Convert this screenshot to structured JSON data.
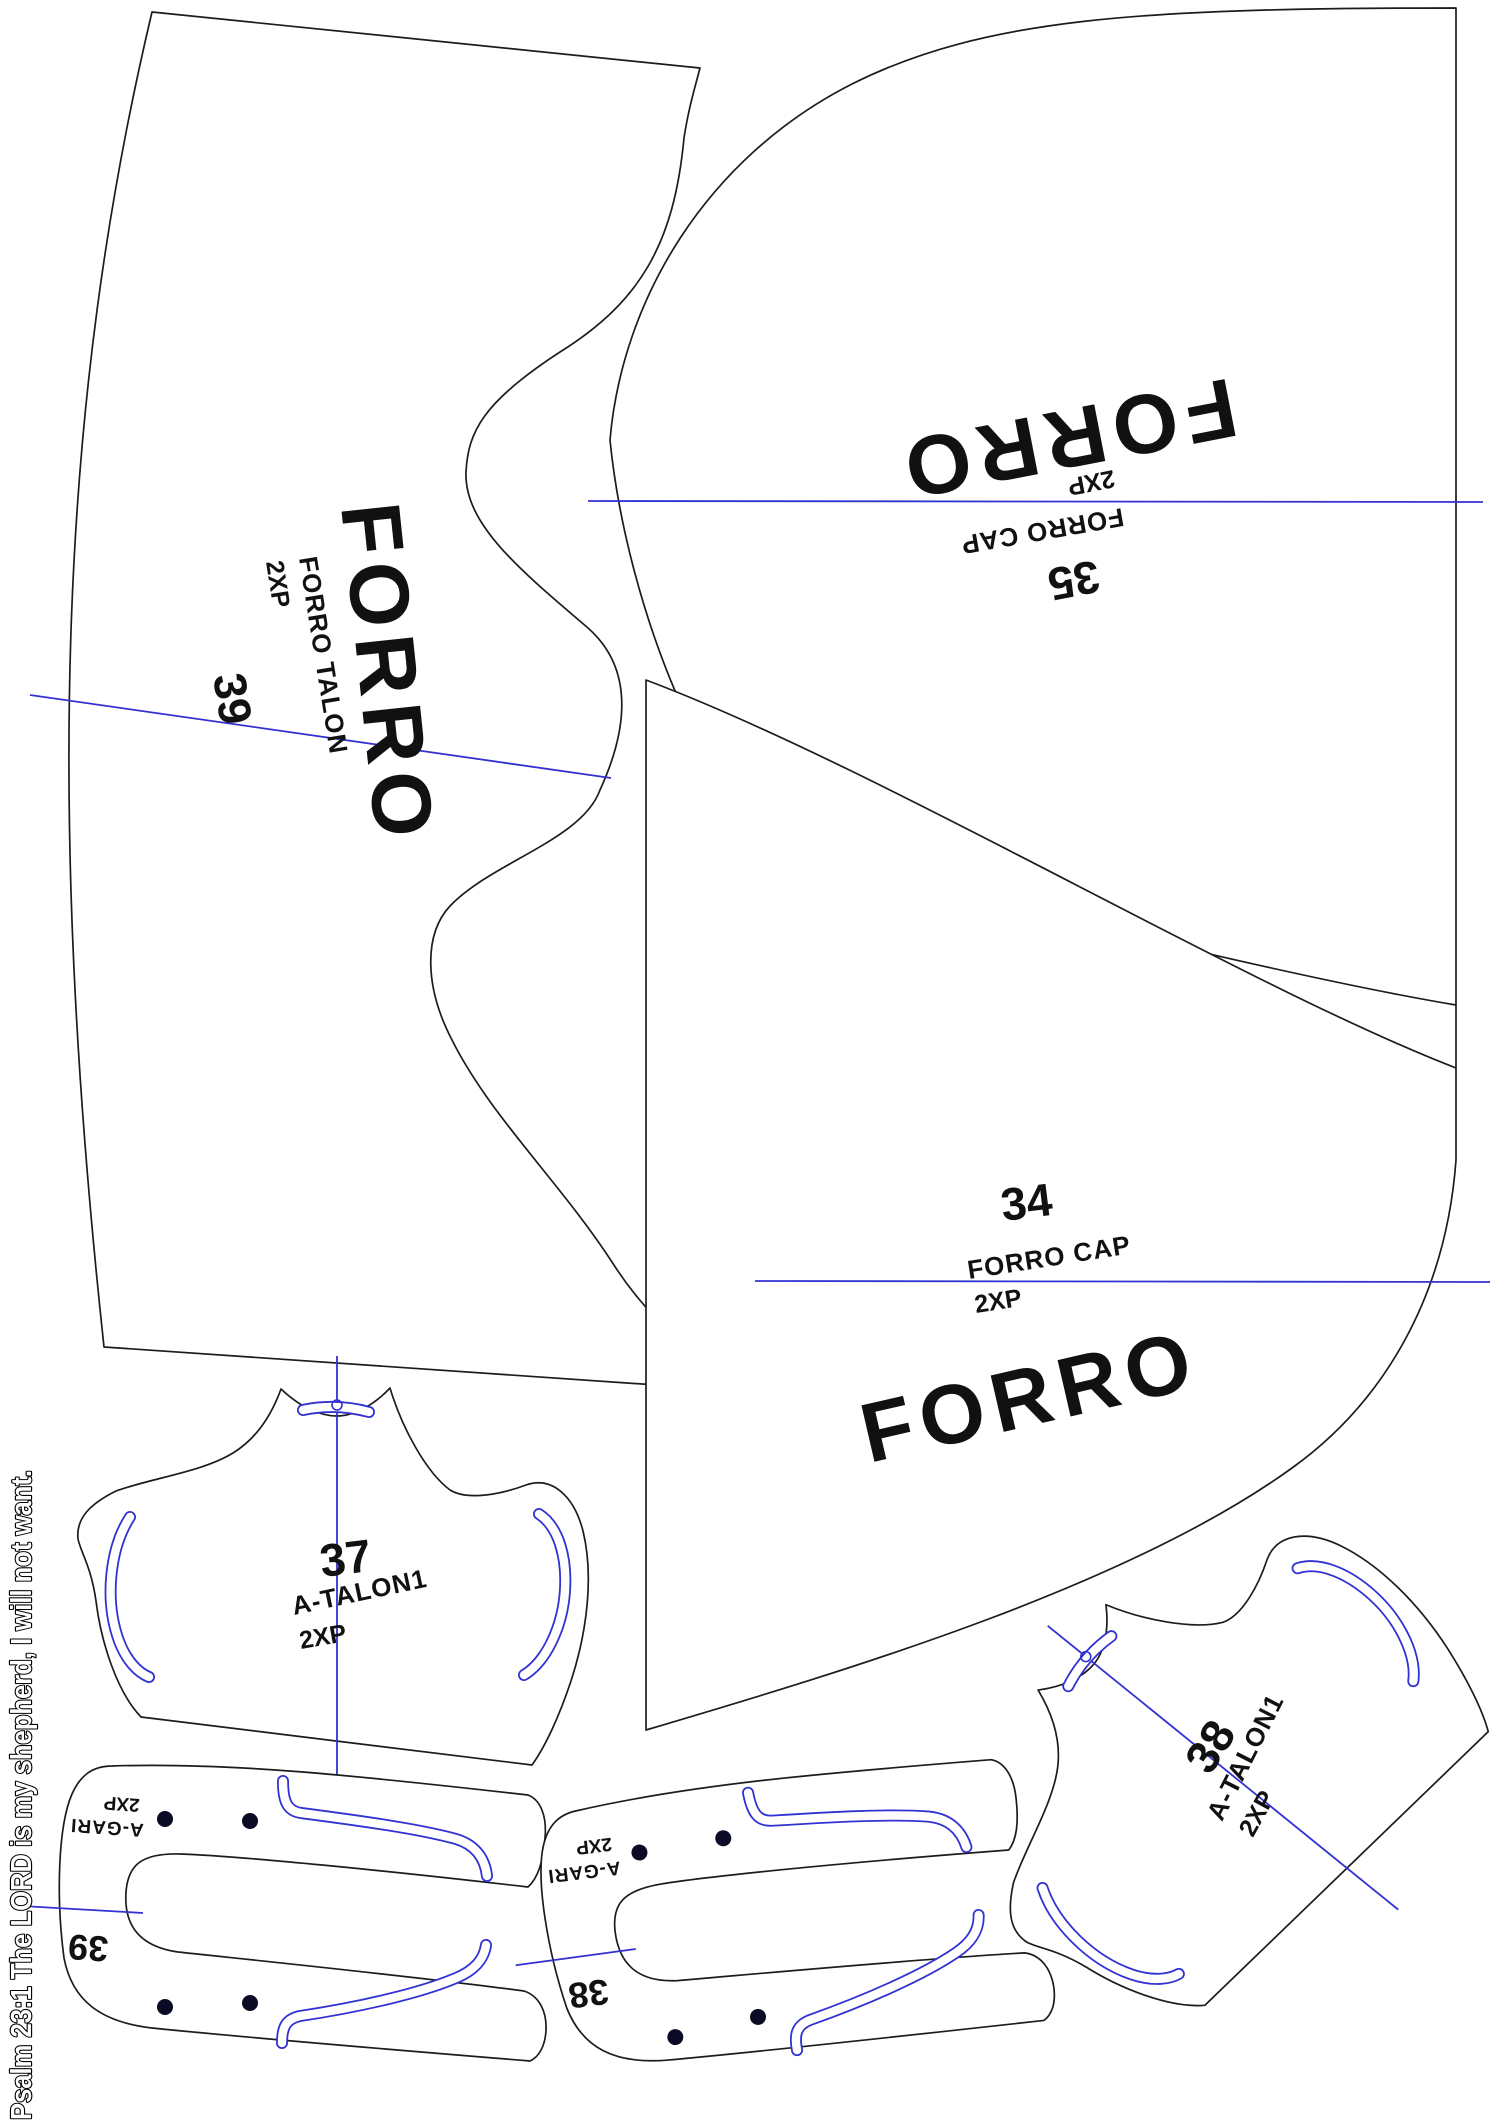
{
  "theme": {
    "paper": "#ffffff",
    "outline": "#1c1c1c",
    "guide": "#3232d2",
    "hole": "#0b0b26",
    "text": "#111111"
  },
  "side_note": {
    "text": "Psalm 23:1 The LORD is my shepherd, I will not want."
  },
  "pieces": {
    "forro_talon_39": {
      "big": "FORRO",
      "name": "FORRO TALON",
      "qty": "2XP",
      "size": "39"
    },
    "forro_cap_35": {
      "big": "FORRO",
      "qty": "2XP",
      "name": "FORRO CAP",
      "size": "35"
    },
    "forro_cap_34": {
      "size": "34",
      "name": "FORRO CAP",
      "qty": "2XP",
      "big": "FORRO"
    },
    "a_talon1_37": {
      "size": "37",
      "name": "A-TALON1",
      "qty": "2XP"
    },
    "a_gari_39": {
      "qty": "2XP",
      "name": "A-GARI",
      "size": "39"
    },
    "a_gari_38": {
      "qty": "2XP",
      "name": "A-GARI",
      "size": "38"
    },
    "a_talon1_38": {
      "size": "38",
      "name": "A-TALON1",
      "qty": "2XP"
    }
  }
}
